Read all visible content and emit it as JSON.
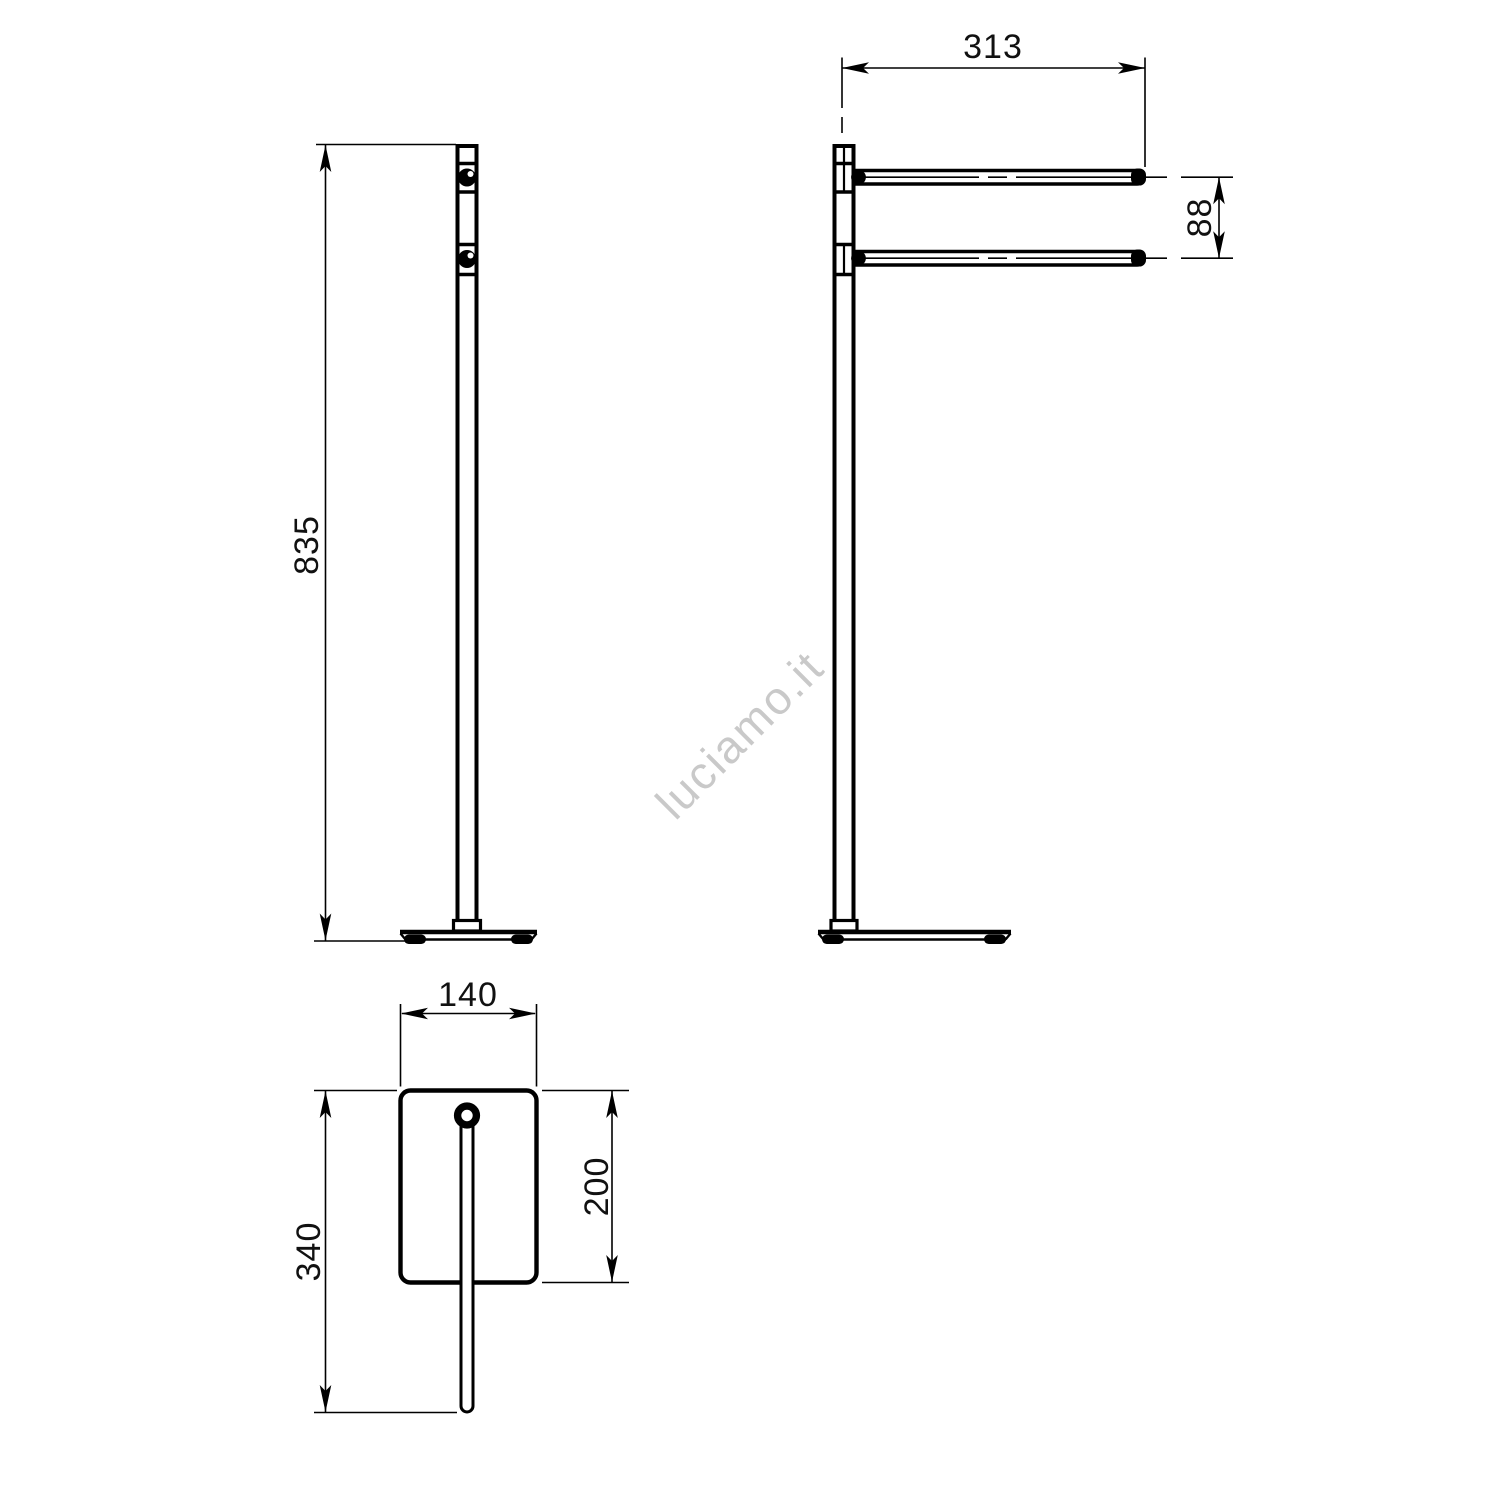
{
  "watermark": {
    "text": "luciamo.it",
    "color": "#c9c9c9"
  },
  "views": {
    "front": {
      "dim_height": "835"
    },
    "side": {
      "dim_bar_length": "313",
      "dim_bar_spacing": "88"
    },
    "plan": {
      "dim_base_width": "140",
      "dim_base_depth": "200",
      "dim_overall_depth": "340"
    }
  },
  "colors": {
    "line": "#000000",
    "dim_text": "#111111",
    "background": "#ffffff"
  }
}
